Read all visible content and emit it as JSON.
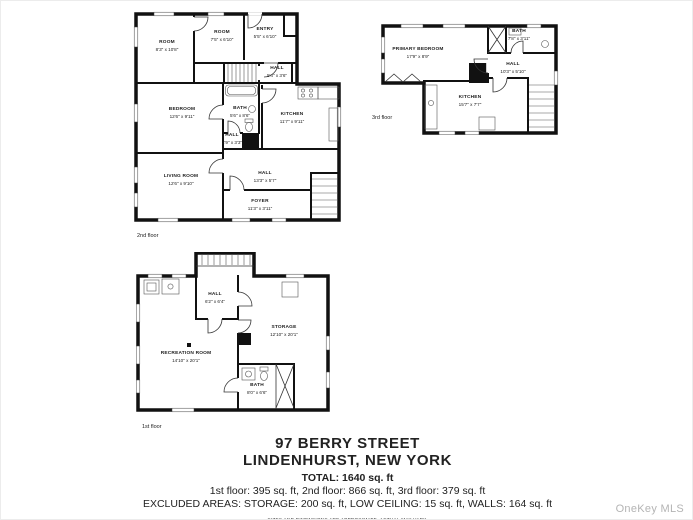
{
  "address": {
    "line1": "97 BERRY STREET",
    "line2": "LINDENHURST, NEW YORK",
    "total": "TOTAL: 1640 sq. ft",
    "floors_line": "1st floor: 395 sq. ft, 2nd floor: 866 sq. ft, 3rd floor: 379 sq. ft",
    "excluded_line": "EXCLUDED AREAS: STORAGE: 200 sq. ft, LOW CEILING: 15 sq. ft, WALLS: 164 sq. ft",
    "disclaimer": "SIZES AND DIMENSIONS ARE APPROXIMATE, ACTUAL MAY VARY."
  },
  "watermark": "OneKey MLS",
  "colors": {
    "wall": "#111111",
    "text": "#1c1c1c",
    "watermark": "#b4b4b4"
  },
  "floors": [
    {
      "label": "2nd floor",
      "rooms": [
        {
          "name": "ROOM",
          "dims": "8'3\" x 10'8\""
        },
        {
          "name": "ROOM",
          "dims": "7'5\" x 6'10\""
        },
        {
          "name": "ENTRY",
          "dims": "5'5\" x 6'10\""
        },
        {
          "name": "HALL",
          "dims": "5'4\" x 3'6\""
        },
        {
          "name": "BEDROOM",
          "dims": "12'6\" x 9'11\""
        },
        {
          "name": "BATH",
          "dims": "5'6\" x 8'6\""
        },
        {
          "name": "KITCHEN",
          "dims": "11'7\" x 9'11\""
        },
        {
          "name": "HALL",
          "dims": "2'9\" x 3'3\""
        },
        {
          "name": "LIVING ROOM",
          "dims": "12'6\" x 9'10\""
        },
        {
          "name": "HALL",
          "dims": "13'3\" x 5'7\""
        },
        {
          "name": "FOYER",
          "dims": "11'3\" x 3'11\""
        }
      ]
    },
    {
      "label": "3rd floor",
      "rooms": [
        {
          "name": "PRIMARY BEDROOM",
          "dims": "17'9\" x 8'9\""
        },
        {
          "name": "BATH",
          "dims": "7'8\" x 3'11\""
        },
        {
          "name": "HALL",
          "dims": "10'3\" x 5'10\""
        },
        {
          "name": "KITCHEN",
          "dims": "15'7\" x 7'7\""
        }
      ]
    },
    {
      "label": "1st floor",
      "rooms": [
        {
          "name": "HALL",
          "dims": "6'2\" x 6'4\""
        },
        {
          "name": "STORAGE",
          "dims": "12'10\" x 20'1\""
        },
        {
          "name": "RECREATION ROOM",
          "dims": "14'10\" x 20'1\""
        },
        {
          "name": "BATH",
          "dims": "8'0\" x 6'6\""
        }
      ]
    }
  ]
}
